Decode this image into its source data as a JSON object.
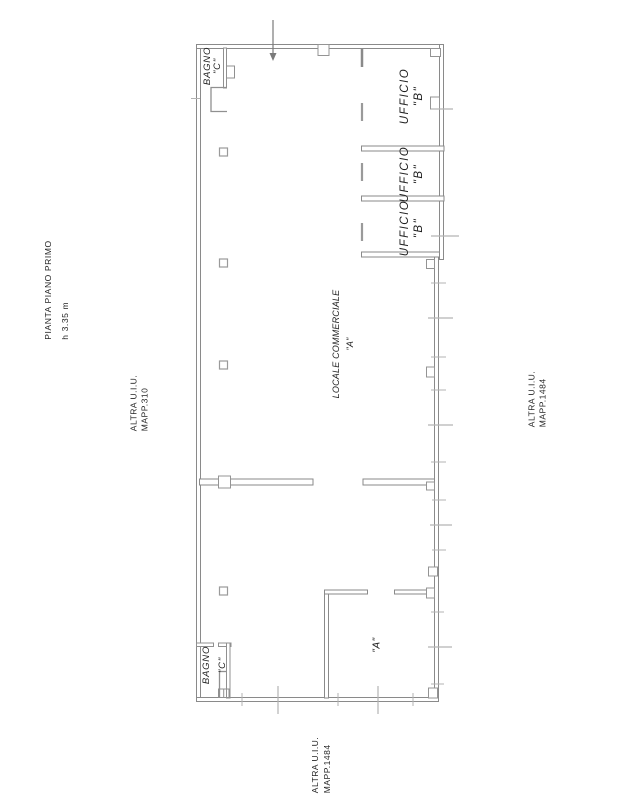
{
  "drawing_title": {
    "line1": "PIANTA PIANO PRIMO",
    "line2": "h 3.35 m"
  },
  "adjacent_units": {
    "left": {
      "line1": "ALTRA U.I.U.",
      "line2": "MAPP.310"
    },
    "right": {
      "line1": "ALTRA U.I.U.",
      "line2": "MAPP.1484"
    },
    "bottom": {
      "line1": "ALTRA U.I.U.",
      "line2": "MAPP.1484"
    }
  },
  "rooms": {
    "bagno_top": {
      "name": "BAGNO",
      "id": "\"C\""
    },
    "ufficio_1": {
      "name": "UFFICIO",
      "id": "\"B\""
    },
    "ufficio_2": {
      "name": "UFFICIO",
      "id": "\"B\""
    },
    "ufficio_3": {
      "name": "UFFICIO",
      "id": "\"B\""
    },
    "locale_commerciale": {
      "name": "LOCALE COMMERCIALE",
      "id": "\"A\""
    },
    "lower_room_a": {
      "id": "\"A\""
    },
    "bagno_bottom": {
      "name": "BAGNO",
      "id": "\"C\""
    }
  },
  "colors": {
    "wall": "#8a8a8a",
    "wall_light": "#b3b3b3",
    "fixture": "#949494",
    "text": "#1f1f1f"
  }
}
